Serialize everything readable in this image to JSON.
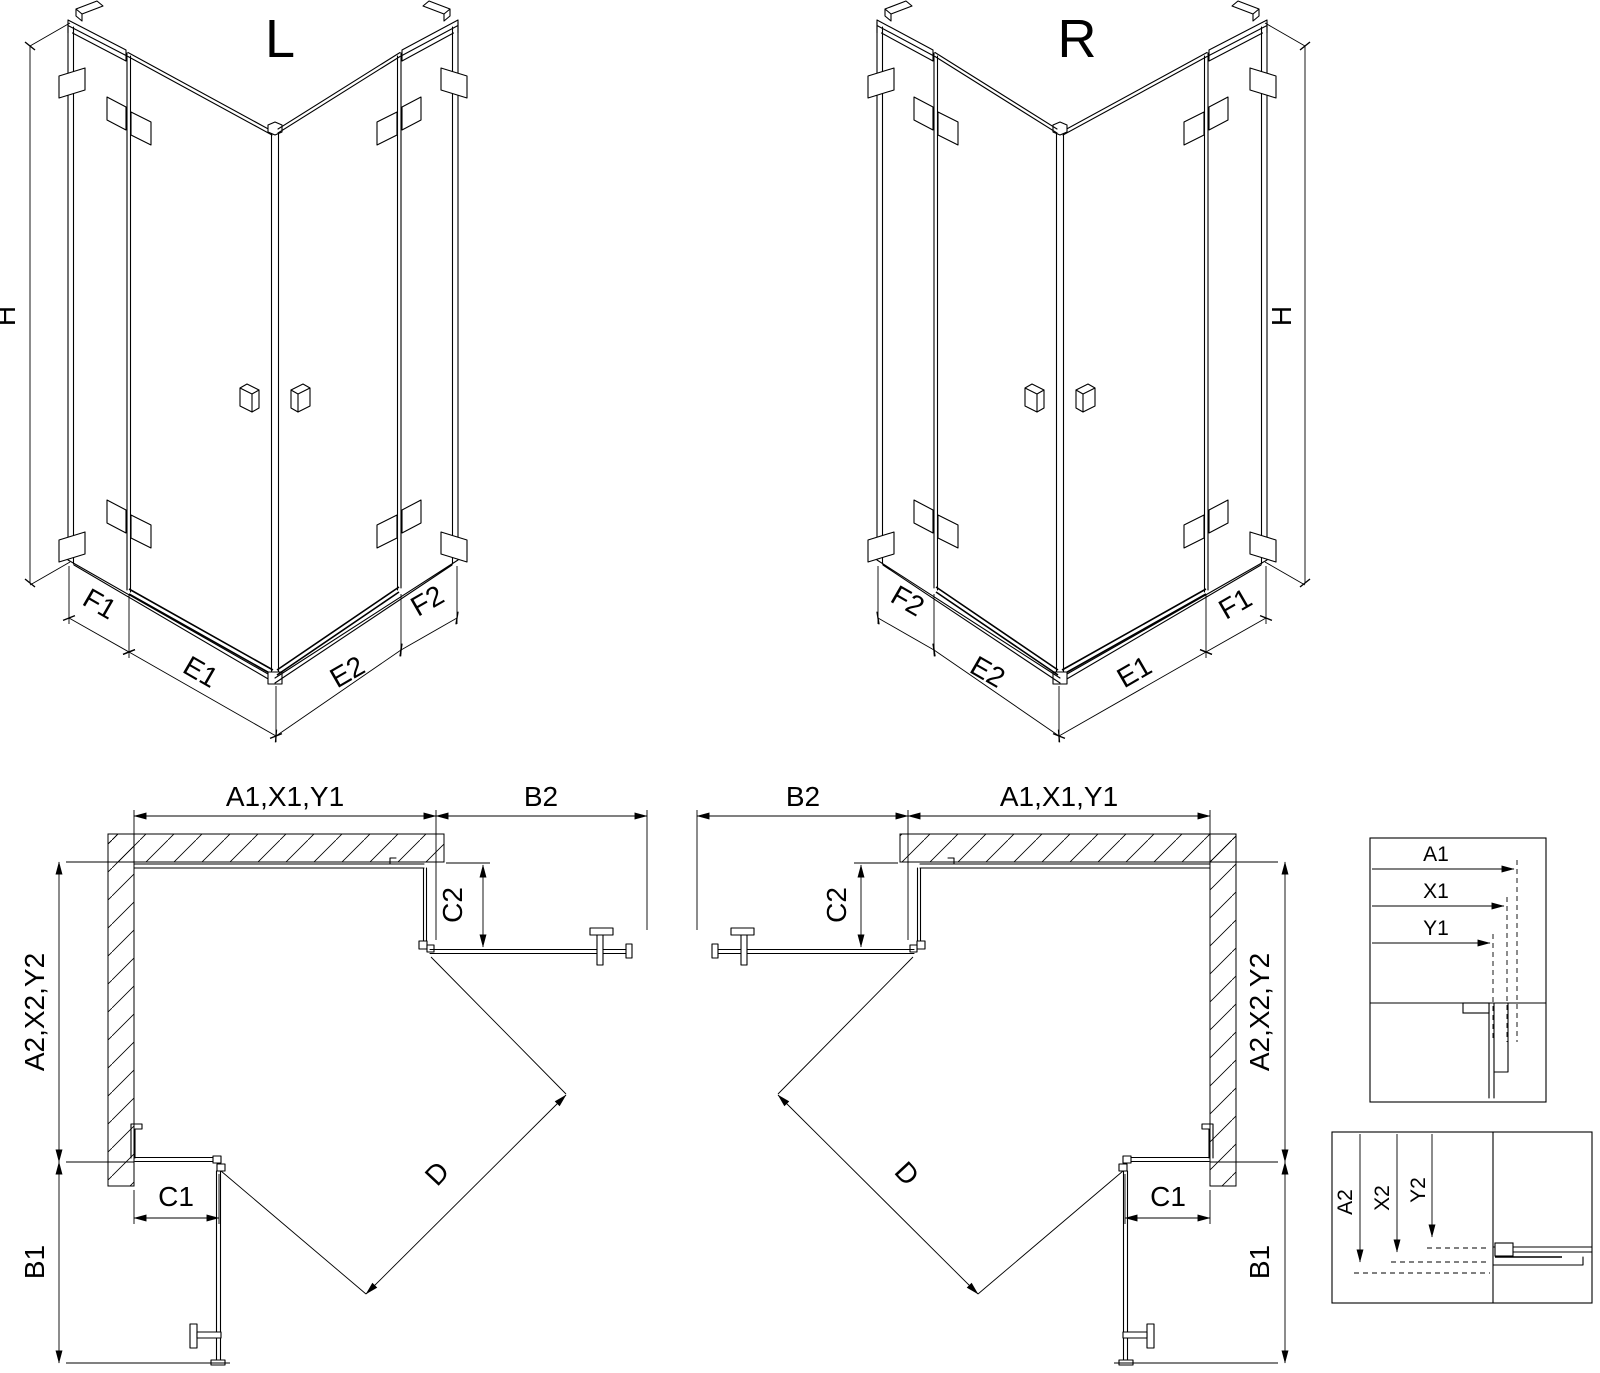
{
  "figure": {
    "iso_left": {
      "title": "L",
      "height": "H",
      "segments": {
        "f1": "F1",
        "e1": "E1",
        "e2": "E2",
        "f2": "F2"
      }
    },
    "iso_right": {
      "title": "R",
      "height": "H",
      "segments": {
        "f2": "F2",
        "e2": "E2",
        "e1": "E1",
        "f1": "F1"
      }
    },
    "plan_left": {
      "width_top": "A1,X1,Y1",
      "entry_top": "B2",
      "panel_right": "C2",
      "depth_left": "A2,X2,Y2",
      "entry_left": "B1",
      "panel_bottom": "C1",
      "diagonal": "D"
    },
    "plan_right": {
      "width_top": "A1,X1,Y1",
      "entry_top": "B2",
      "panel_left": "C2",
      "depth_right": "A2,X2,Y2",
      "entry_right": "B1",
      "panel_bottom": "C1",
      "diagonal": "D"
    },
    "detail_horizontal": {
      "a1": "A1",
      "x1": "X1",
      "y1": "Y1"
    },
    "detail_vertical": {
      "a2": "A2",
      "x2": "X2",
      "y2": "Y2"
    }
  },
  "colors": {
    "line": "#000000",
    "background": "#ffffff"
  }
}
